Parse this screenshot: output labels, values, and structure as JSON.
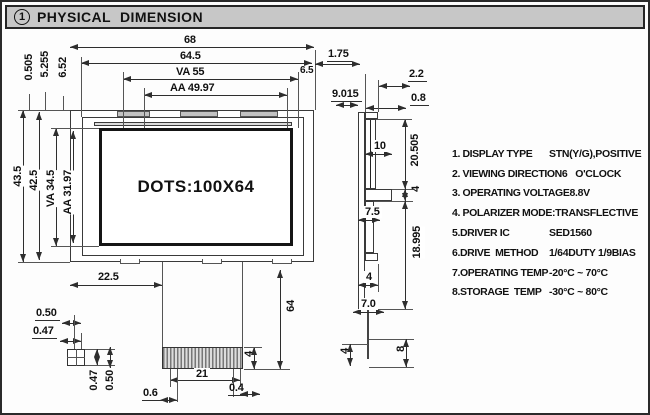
{
  "title": {
    "number": "1",
    "text": "PHYSICAL  DIMENSION"
  },
  "front_view": {
    "dots_label": "DOTS:100X64"
  },
  "dims": {
    "top": {
      "w68": "68",
      "w645": "64.5",
      "va55": "VA 55",
      "aa4997": "AA 49.97",
      "d175": "1.75",
      "d65": "6.5",
      "d9015": "9.015",
      "d22": "2.2",
      "d08": "0.8"
    },
    "left": {
      "h435": "43.5",
      "h425": "42.5",
      "va345": "VA 34.5",
      "aa3197": "AA 31.97",
      "d0505": "0.505",
      "d5255": "5.255",
      "d652": "6.52"
    },
    "bottom": {
      "d225": "22.5",
      "d64": "64",
      "d4conn": "4",
      "d21": "21",
      "d06": "0.6",
      "d04": "0.4",
      "d050top": "0.50",
      "d047top": "0.47",
      "d047rot": "0.47",
      "d050rot": "0.50"
    },
    "side": {
      "d10": "10",
      "d20505": "20.505",
      "d4mid": "4",
      "d75": "7.5",
      "d18995": "18.995",
      "d4tab": "4",
      "d70": "7.0",
      "d4flex": "4",
      "d8": "8"
    }
  },
  "specs": {
    "rows": [
      {
        "label": "1. DISPLAY TYPE",
        "value": "STN(Y/G),POSITIVE"
      },
      {
        "label": "2. VIEWING DIRECTION",
        "value": "6   O'CLOCK"
      },
      {
        "label": "3. OPERATING VOLTAGE",
        "value": "8.8V"
      },
      {
        "label": "4. POLARIZER MODE:",
        "value": "TRANSFLECTIVE"
      },
      {
        "label": "5.DRIVER IC",
        "value": "SED1560"
      },
      {
        "label": "6.DRIVE  METHOD",
        "value": "1/64DUTY 1/9BIAS"
      },
      {
        "label": "7.OPERATING TEMP",
        "value": "-20°C ~ 70°C"
      },
      {
        "label": "8.STORAGE  TEMP",
        "value": "-30°C ~ 80°C"
      }
    ]
  }
}
